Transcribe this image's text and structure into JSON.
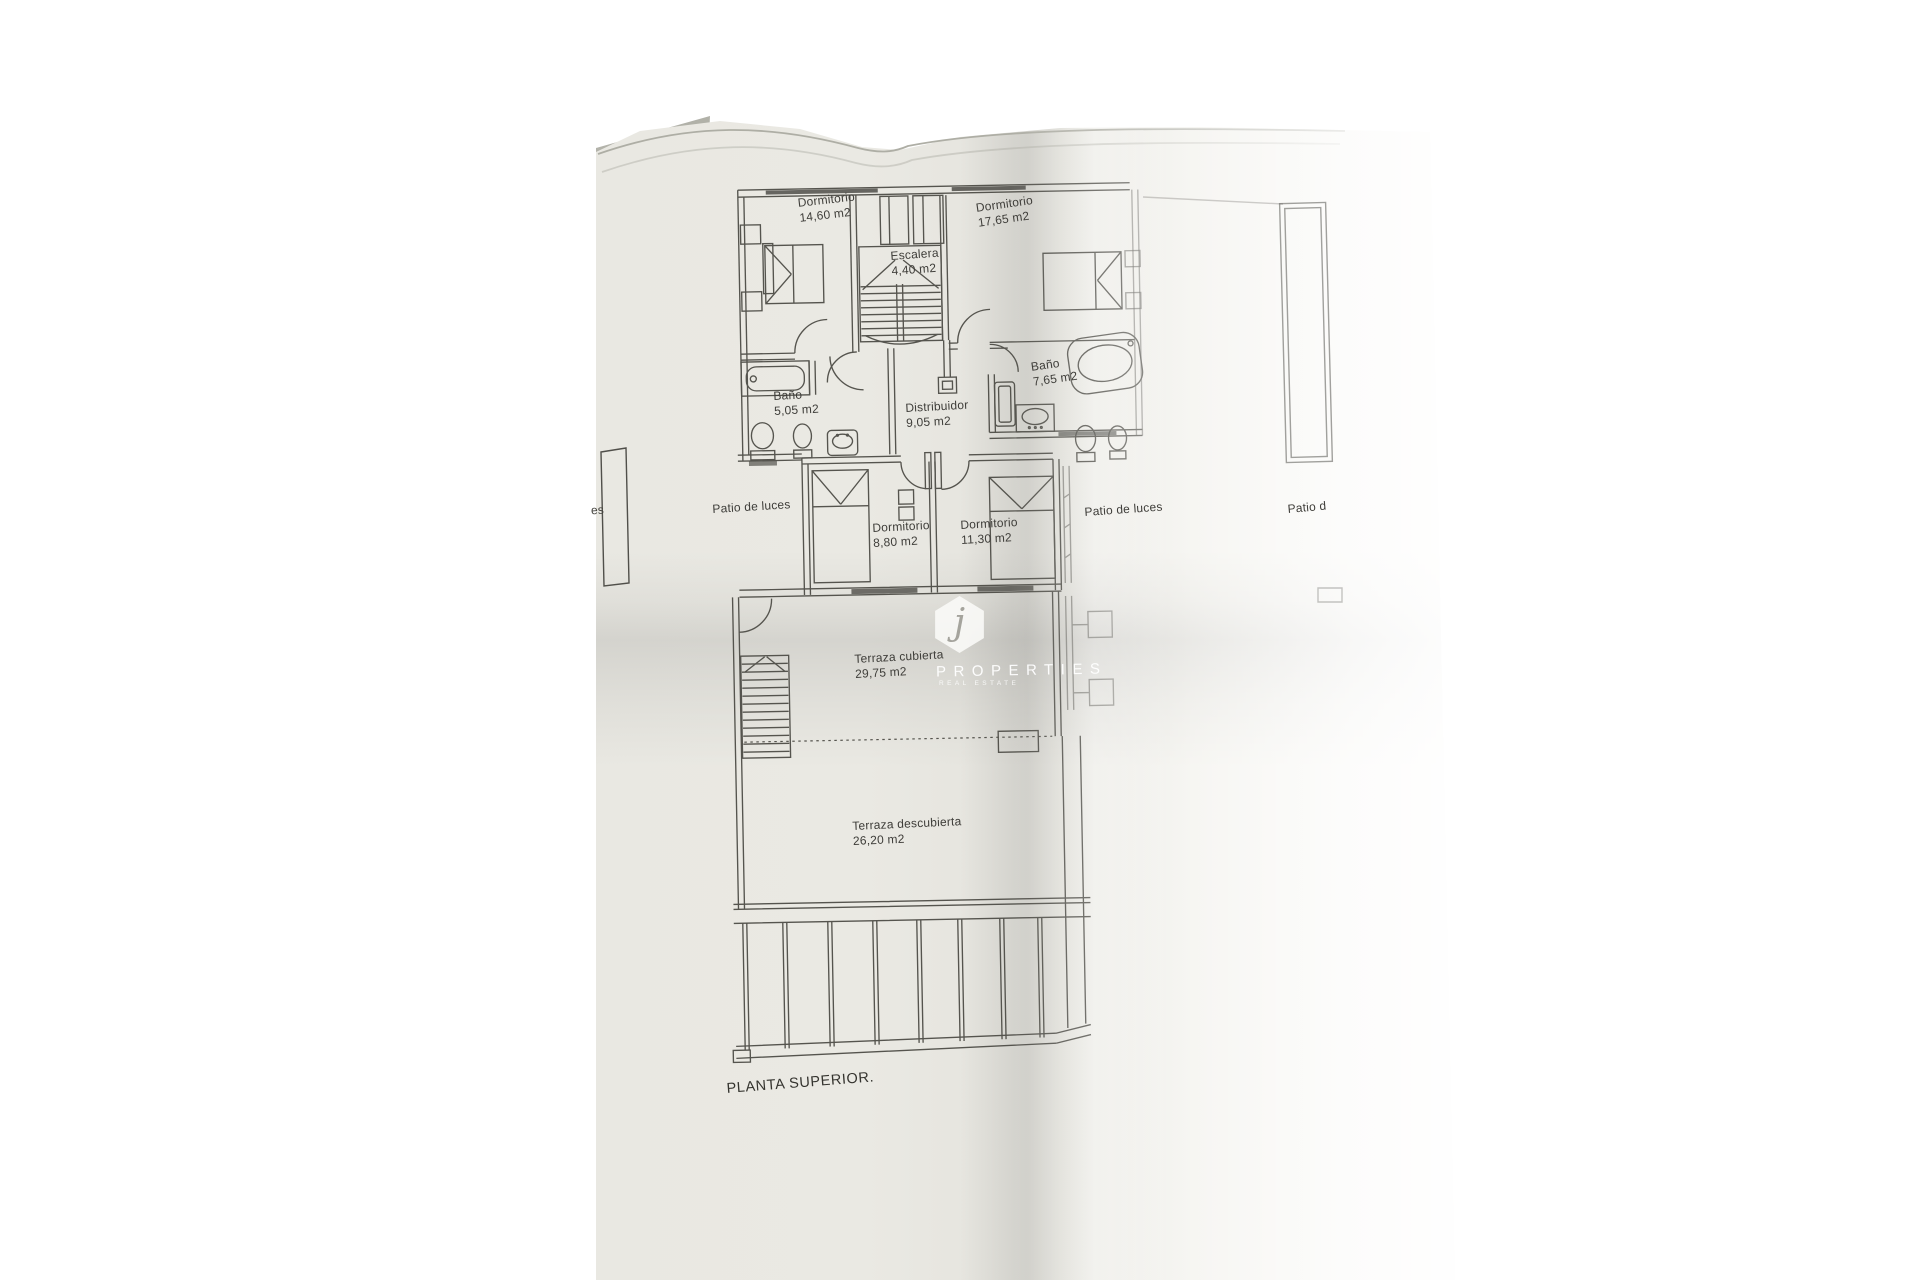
{
  "plan": {
    "title": "PLANTA SUPERIOR.",
    "left_page_fragment": "es"
  },
  "rooms": {
    "dorm_top_left": {
      "name": "Dormitorio",
      "area": "14,60 m2"
    },
    "dorm_top_right": {
      "name": "Dormitorio",
      "area": "17,65 m2"
    },
    "escalera": {
      "name": "Escalera",
      "area": "4,40 m2"
    },
    "bano_left": {
      "name": "Baño",
      "area": "5,05 m2"
    },
    "bano_right": {
      "name": "Baño",
      "area": "7,65 m2"
    },
    "distribuidor": {
      "name": "Distribuidor",
      "area": "9,05 m2"
    },
    "patio_left": {
      "name": "Patio de luces"
    },
    "dorm_mid_left": {
      "name": "Dormitorio",
      "area": "8,80 m2"
    },
    "dorm_mid_right": {
      "name": "Dormitorio",
      "area": "11,30 m2"
    },
    "patio_right": {
      "name": "Patio de luces"
    },
    "patio_far_right": {
      "name": "Patio d"
    },
    "terraza_cubierta": {
      "name": "Terraza cubierta",
      "area": "29,75 m2"
    },
    "terraza_descubierta": {
      "name": "Terraza descubierta",
      "area": "26,20 m2"
    }
  },
  "watermark": {
    "initial": "j",
    "brand": "PROPERTIES",
    "tagline": "REAL ESTATE"
  },
  "colors": {
    "ink": "#55544e",
    "paper": "#e9e8e2",
    "text": "#3e3d39"
  }
}
